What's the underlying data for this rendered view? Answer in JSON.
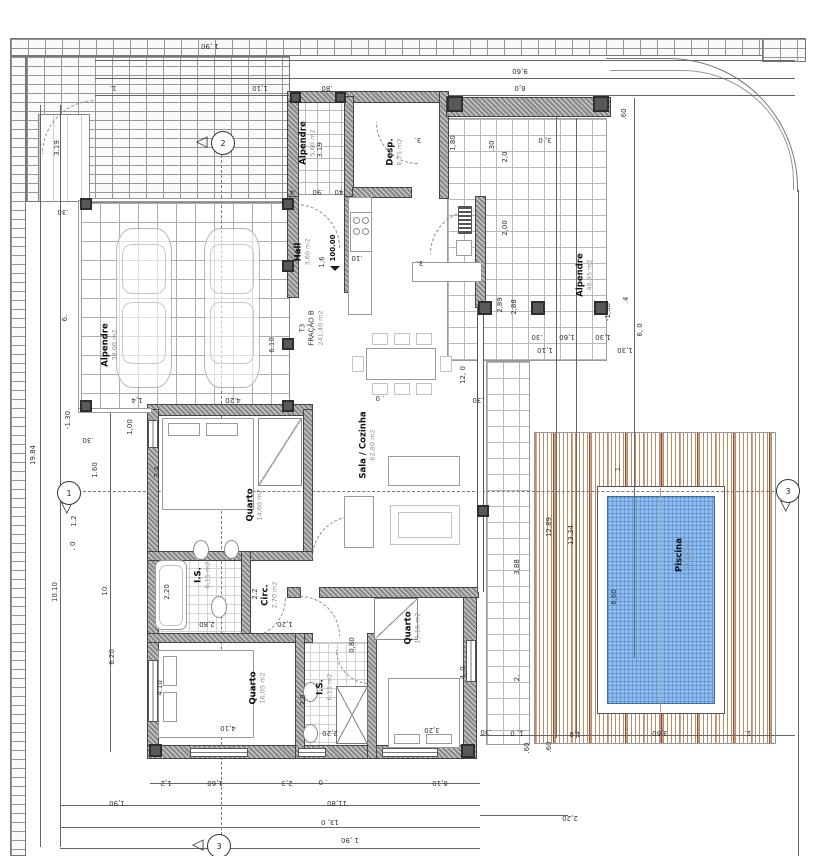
{
  "drawing": {
    "type": "architectural floor plan",
    "unit": {
      "lines": [
        "T3",
        "FRAÇÃO B",
        "241,40 m2"
      ],
      "x": 312,
      "y": 328
    },
    "level": {
      "value": "100.00",
      "x": 333,
      "y": 248
    }
  },
  "colors": {
    "pool_fill": "#8cbcec",
    "deck_wood": "#b4714a",
    "wall_gray": "#8c8c8c",
    "paving_line": "#969696"
  },
  "rooms": [
    {
      "label": "Alpendre",
      "area": "38,00 m2",
      "x": 110,
      "y": 345
    },
    {
      "label": "Alpendre",
      "area": "5,60 m2",
      "x": 308,
      "y": 143
    },
    {
      "label": "Hall",
      "area": "3,60 m2",
      "x": 303,
      "y": 252
    },
    {
      "label": "Desp.",
      "area": "6,75 m2",
      "x": 395,
      "y": 152
    },
    {
      "label": "Sala / Cozinha",
      "area": "62,80 m2",
      "x": 368,
      "y": 445
    },
    {
      "label": "Quarto",
      "area": "14,60 m2",
      "x": 255,
      "y": 505
    },
    {
      "label": "I.S.",
      "area": "6,15 m2",
      "x": 203,
      "y": 575
    },
    {
      "label": "Circ.",
      "area": "2,70 m2",
      "x": 270,
      "y": 595
    },
    {
      "label": "Quarto",
      "area": "16,05 m2",
      "x": 258,
      "y": 688
    },
    {
      "label": "I.S.",
      "area": "6,15 m2",
      "x": 325,
      "y": 687
    },
    {
      "label": "Quarto",
      "area": "19,15 m2",
      "x": 413,
      "y": 628
    },
    {
      "label": "Alpendre",
      "area": "40,95 m2",
      "x": 585,
      "y": 275
    },
    {
      "label": "Piscina",
      "area": "23,60 m2",
      "x": 684,
      "y": 555
    }
  ],
  "markers": [
    {
      "n": "1",
      "x": 68,
      "y": 492,
      "d": "down"
    },
    {
      "n": "2",
      "x": 222,
      "y": 142,
      "d": "left"
    },
    {
      "n": "3",
      "x": 218,
      "y": 845,
      "d": "left"
    },
    {
      "n": "3",
      "x": 787,
      "y": 490,
      "d": "down"
    }
  ],
  "dims": [
    {
      "t": "1 ,90",
      "x": 210,
      "y": 46,
      "r": 180
    },
    {
      "t": "9,60",
      "x": 520,
      "y": 71,
      "r": 180
    },
    {
      "t": "1.",
      "x": 113,
      "y": 88,
      "r": 180
    },
    {
      "t": "1,10",
      "x": 260,
      "y": 88,
      "r": 180
    },
    {
      "t": ".80",
      "x": 327,
      "y": 88,
      "r": 180
    },
    {
      "t": "6,0",
      "x": 520,
      "y": 88,
      "r": 180
    },
    {
      "t": "3.19",
      "x": 57,
      "y": 148,
      "r": -90
    },
    {
      "t": "3.19",
      "x": 320,
      "y": 150,
      "r": -90
    },
    {
      "t": "1,80",
      "x": 453,
      "y": 143,
      "r": -90
    },
    {
      "t": "3, 0",
      "x": 545,
      "y": 140,
      "r": 180
    },
    {
      "t": ".60",
      "x": 624,
      "y": 114,
      "r": -90
    },
    {
      "t": "2,0",
      "x": 505,
      "y": 157,
      "r": -90
    },
    {
      "t": "2,00",
      "x": 505,
      "y": 228,
      "r": -90
    },
    {
      "t": "6, 0",
      "x": 640,
      "y": 330,
      "r": -90
    },
    {
      "t": ".4",
      "x": 626,
      "y": 300,
      "r": -90
    },
    {
      "t": "2,88",
      "x": 514,
      "y": 307,
      "r": -90
    },
    {
      "t": "2,89",
      "x": 500,
      "y": 305,
      "r": -90
    },
    {
      "t": "-1,30",
      "x": 608,
      "y": 312,
      "r": -90
    },
    {
      "t": ".30",
      "x": 537,
      "y": 337,
      "r": 180
    },
    {
      "t": "1,60",
      "x": 567,
      "y": 337,
      "r": 180
    },
    {
      "t": "1,30",
      "x": 603,
      "y": 337,
      "r": 180
    },
    {
      "t": "1,10",
      "x": 545,
      "y": 350,
      "r": 180
    },
    {
      "t": "1,30",
      "x": 625,
      "y": 350,
      "r": 180
    },
    {
      "t": ".30",
      "x": 492,
      "y": 146,
      "r": -90
    },
    {
      "t": ".4",
      "x": 293,
      "y": 192,
      "r": 180
    },
    {
      "t": ".90",
      "x": 318,
      "y": 192,
      "r": 180
    },
    {
      "t": ".40",
      "x": 340,
      "y": 192,
      "r": 180
    },
    {
      "t": ".10",
      "x": 357,
      "y": 258,
      "r": 180
    },
    {
      "t": "1,6",
      "x": 322,
      "y": 262,
      "r": -90
    },
    {
      "t": "3.",
      "x": 420,
      "y": 263,
      "r": 180
    },
    {
      "t": "3.",
      "x": 418,
      "y": 140,
      "r": 180
    },
    {
      "t": ". 0",
      "x": 380,
      "y": 398,
      "r": 180
    },
    {
      "t": ".30",
      "x": 478,
      "y": 400,
      "r": 180
    },
    {
      "t": "12, 0",
      "x": 463,
      "y": 375,
      "r": -90
    },
    {
      "t": "19.84",
      "x": 33,
      "y": 455,
      "r": -90
    },
    {
      "t": "10.10",
      "x": 55,
      "y": 592,
      "r": -90
    },
    {
      "t": "10.",
      "x": 105,
      "y": 590,
      "r": -90
    },
    {
      "t": "6.",
      "x": 65,
      "y": 318,
      "r": -90
    },
    {
      "t": ".30",
      "x": 63,
      "y": 212,
      "r": 180
    },
    {
      "t": "-1.30",
      "x": 68,
      "y": 420,
      "r": -90
    },
    {
      "t": ".30",
      "x": 88,
      "y": 440,
      "r": 180
    },
    {
      "t": "1,4",
      "x": 137,
      "y": 400,
      "r": 180
    },
    {
      "t": "4.20",
      "x": 233,
      "y": 400,
      "r": 180
    },
    {
      "t": "6.10",
      "x": 272,
      "y": 345,
      "r": -90
    },
    {
      "t": "1,00",
      "x": 130,
      "y": 427,
      "r": -90
    },
    {
      "t": "1.60",
      "x": 95,
      "y": 470,
      "r": -90
    },
    {
      "t": "3.4",
      "x": 157,
      "y": 472,
      "r": -90
    },
    {
      "t": "1.2",
      "x": 74,
      "y": 521,
      "r": -90
    },
    {
      "t": ". 0",
      "x": 73,
      "y": 546,
      "r": -90
    },
    {
      "t": "6.20",
      "x": 112,
      "y": 657,
      "r": -90
    },
    {
      "t": "4.10",
      "x": 160,
      "y": 688,
      "r": -90
    },
    {
      "t": "2,20",
      "x": 167,
      "y": 592,
      "r": -90
    },
    {
      "t": "2.2",
      "x": 255,
      "y": 594,
      "r": -90
    },
    {
      "t": "2,80",
      "x": 207,
      "y": 624,
      "r": 180
    },
    {
      "t": "1,20",
      "x": 285,
      "y": 624,
      "r": 180
    },
    {
      "t": "0,80",
      "x": 352,
      "y": 645,
      "r": -90
    },
    {
      "t": "2,8",
      "x": 303,
      "y": 700,
      "r": -90
    },
    {
      "t": "2,20",
      "x": 330,
      "y": 733,
      "r": 180
    },
    {
      "t": "4,10",
      "x": 228,
      "y": 728,
      "r": 180
    },
    {
      "t": "3,20",
      "x": 432,
      "y": 730,
      "r": 180
    },
    {
      "t": "4, 0",
      "x": 463,
      "y": 673,
      "r": -90
    },
    {
      "t": "2.",
      "x": 517,
      "y": 678,
      "r": -90
    },
    {
      "t": "3,88",
      "x": 517,
      "y": 567,
      "r": -90
    },
    {
      "t": "12.89",
      "x": 549,
      "y": 527,
      "r": -90
    },
    {
      "t": "13.34",
      "x": 571,
      "y": 535,
      "r": -90
    },
    {
      "t": "6,60",
      "x": 614,
      "y": 597,
      "r": -90
    },
    {
      "t": "1.",
      "x": 618,
      "y": 468,
      "r": -90
    },
    {
      "t": "3,60",
      "x": 660,
      "y": 733,
      "r": 180
    },
    {
      "t": "1,8",
      "x": 575,
      "y": 734,
      "r": 180
    },
    {
      "t": "1.",
      "x": 748,
      "y": 733,
      "r": 180
    },
    {
      "t": "2,20",
      "x": 570,
      "y": 818,
      "r": 180
    },
    {
      "t": ".60",
      "x": 527,
      "y": 748,
      "r": -90
    },
    {
      "t": ".60",
      "x": 549,
      "y": 747,
      "r": -90
    },
    {
      "t": "1, 0",
      "x": 517,
      "y": 733,
      "r": 180
    },
    {
      "t": ".30",
      "x": 486,
      "y": 732,
      "r": 180
    },
    {
      "t": "1,2",
      "x": 166,
      "y": 783,
      "r": 180
    },
    {
      "t": "1,60",
      "x": 215,
      "y": 783,
      "r": 180
    },
    {
      "t": "2,3",
      "x": 287,
      "y": 783,
      "r": 180
    },
    {
      "t": ". 0",
      "x": 323,
      "y": 782,
      "r": 180
    },
    {
      "t": "6,10",
      "x": 440,
      "y": 783,
      "r": 180
    },
    {
      "t": "1,90",
      "x": 117,
      "y": 803,
      "r": 180
    },
    {
      "t": "11,80",
      "x": 337,
      "y": 803,
      "r": 180
    },
    {
      "t": "13, 0",
      "x": 330,
      "y": 822,
      "r": 180
    },
    {
      "t": "1 ,90",
      "x": 350,
      "y": 840,
      "r": 180
    }
  ]
}
